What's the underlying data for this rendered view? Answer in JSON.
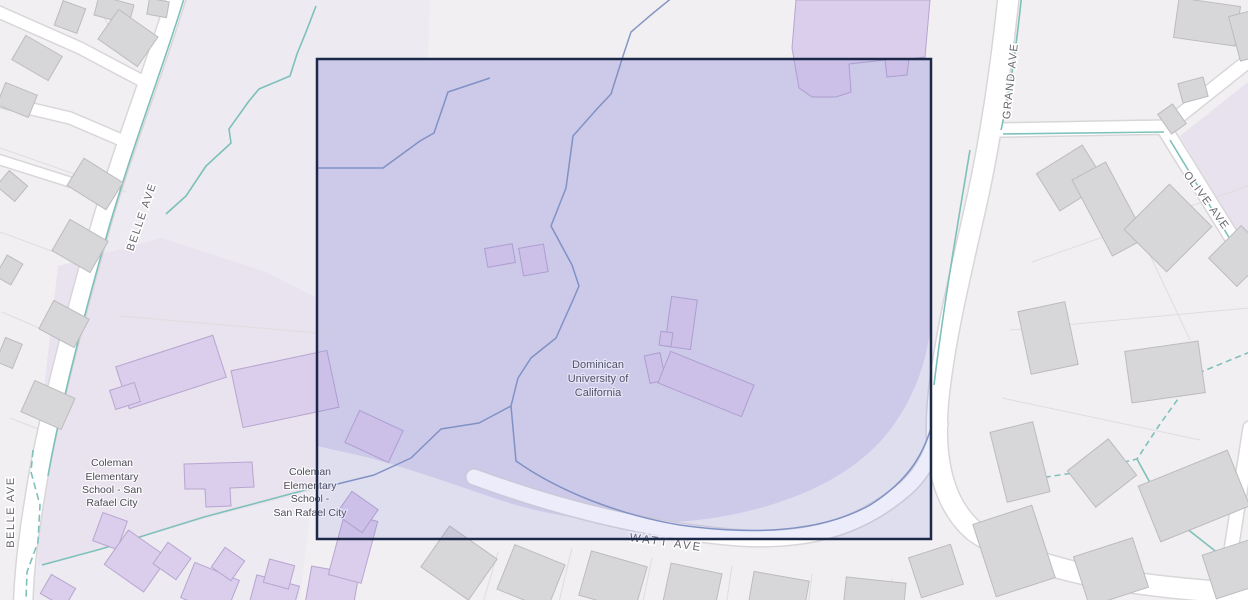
{
  "map": {
    "road_labels": {
      "belle_ave_north": "BELLE AVE",
      "belle_ave_south": "BELLE AVE",
      "grand_ave": "GRAND AVE",
      "olive_ave": "OLIVE AVE",
      "watt_ave": "WATT AVE"
    },
    "poi_labels": {
      "dominican_university": {
        "lines": [
          "Dominican",
          "University of",
          "California"
        ]
      },
      "coleman_school_west": {
        "lines": [
          "Coleman",
          "Elementary",
          "School - San",
          "Rafael City"
        ]
      },
      "coleman_school_east": {
        "lines": [
          "Coleman",
          "Elementary",
          "School -",
          "San Rafael City"
        ]
      }
    }
  },
  "selection": {
    "x": 317,
    "y": 59,
    "width": 614,
    "height": 480
  },
  "colors": {
    "background": "#f1eff2",
    "zone_light_purple": "#edeaf2",
    "zone_school_purple": "#e9e2ef",
    "zone_campus_purple": "#dcd7ec",
    "zone_ne_purple": "#e7e2ee",
    "road_fill": "#ffffff",
    "road_casing": "#d9d6d9",
    "parcel_line": "#dfddde",
    "creek_teal": "#7ec0ba",
    "creek_blue": "#8498c2",
    "building_gray": "#d7d6d8",
    "building_gray_stroke": "#bcbbbd",
    "building_purple": "#dbcdec",
    "building_purple_stroke": "#b7a6cf",
    "label_road": "#65656d",
    "label_poi": "#4d4d58",
    "selection_border": "#1c2847",
    "selection_fill": "rgba(108,112,215,0.13)"
  }
}
